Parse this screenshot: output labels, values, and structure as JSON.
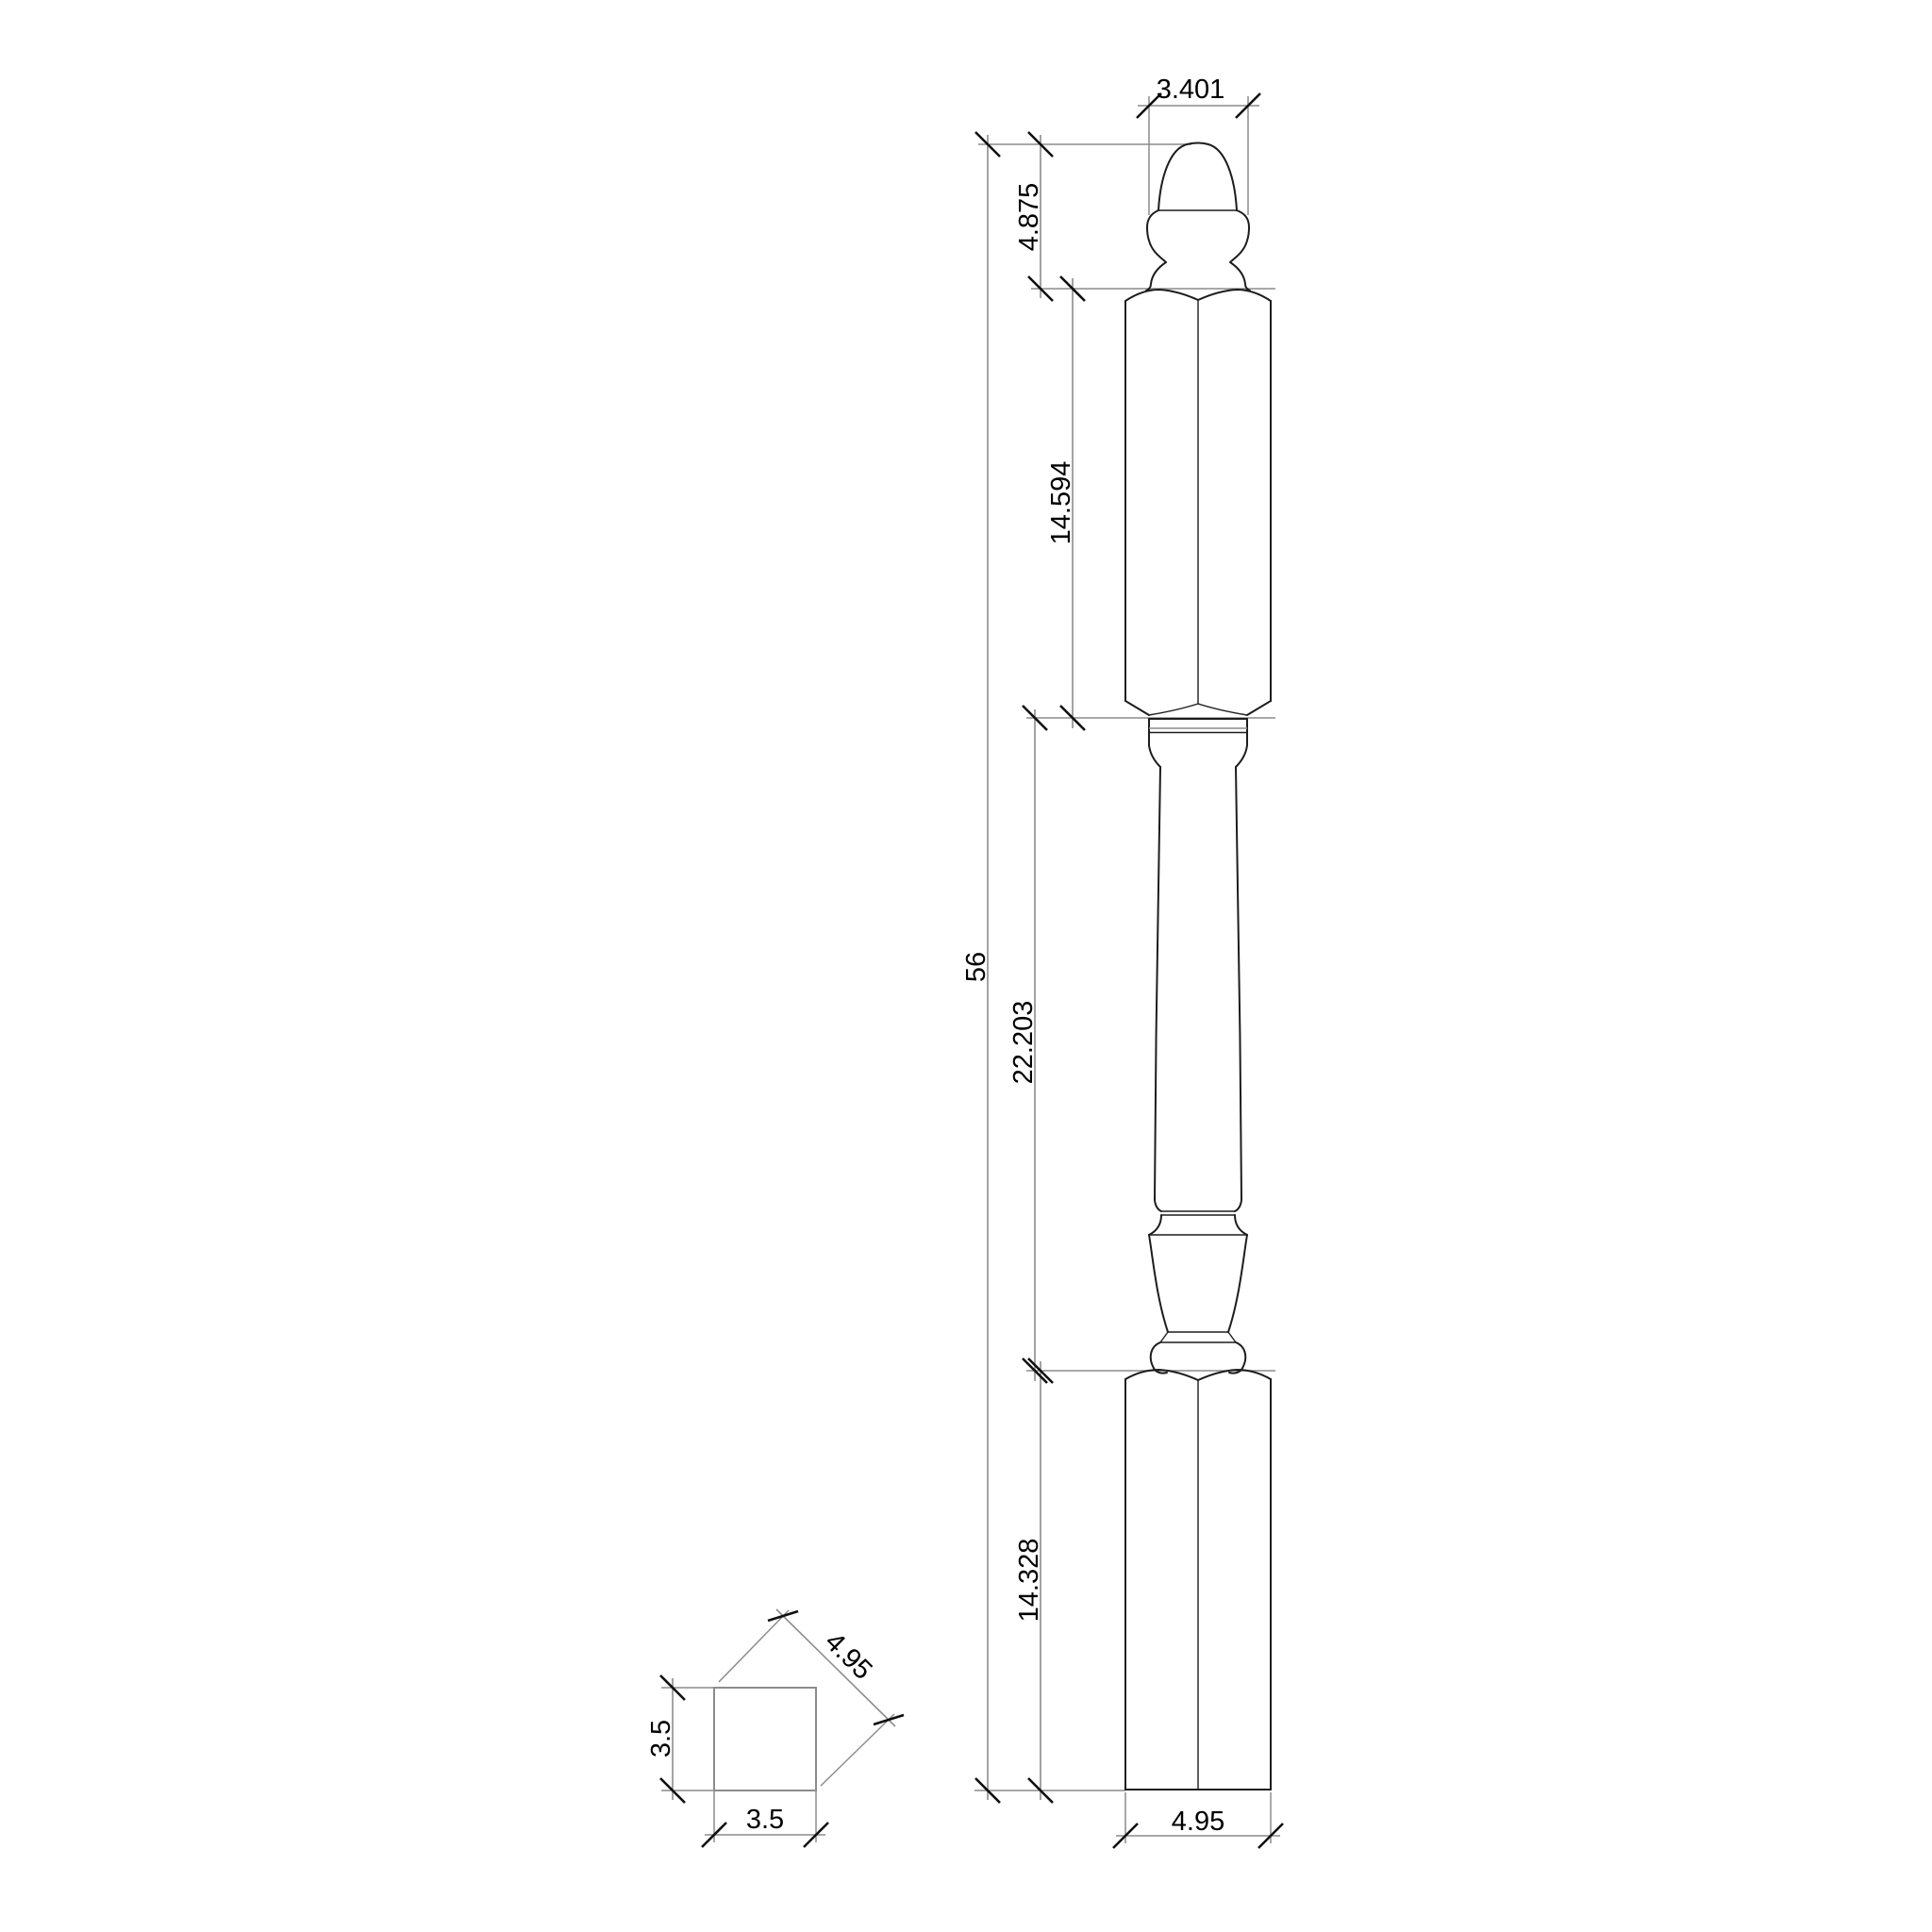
{
  "drawing_type": "newel-post-technical-drawing",
  "colors": {
    "background": "#ffffff",
    "outline": "#1d1d1d",
    "construction": "#8c8c8c",
    "tick": "#101010",
    "text": "#000000"
  },
  "elevation": {
    "dims": {
      "finial_width": "3.401",
      "finial_height": "4.875",
      "top_block_height": "14.594",
      "overall_height": "56",
      "turning_height": "22.203",
      "bottom_block_height": "14.328",
      "base_width": "4.95"
    }
  },
  "section": {
    "dims": {
      "height": "3.5",
      "width": "3.5",
      "diagonal": "4.95"
    }
  }
}
